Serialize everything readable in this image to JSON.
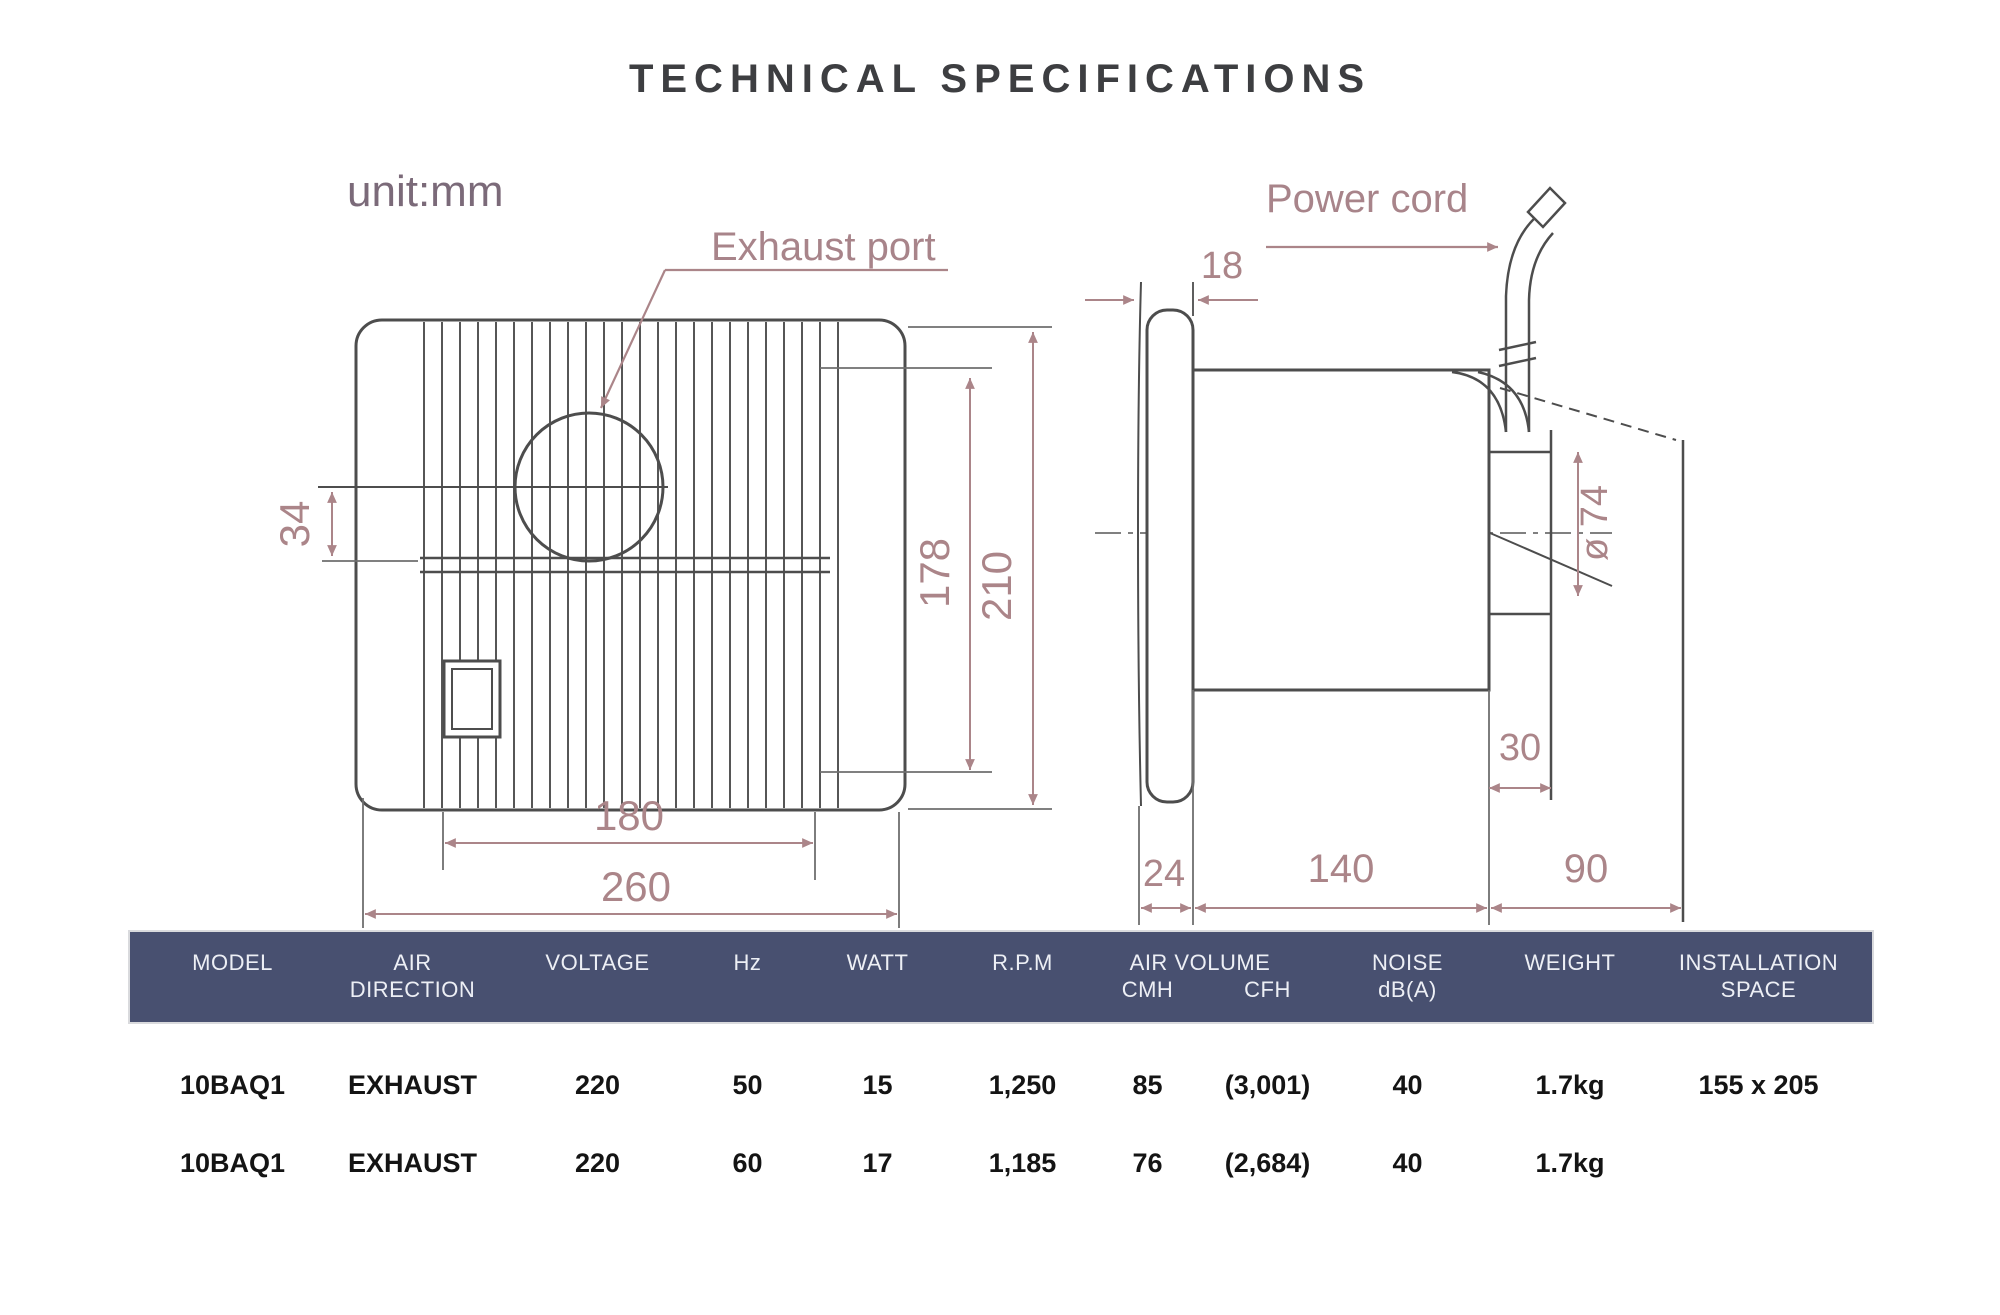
{
  "title": "TECHNICAL SPECIFICATIONS",
  "diagram": {
    "unit_label": "unit:mm",
    "exhaust_port_label": "Exhaust port",
    "power_cord_label": "Power cord",
    "front_view": {
      "switch_offset": "34",
      "inner_height": "178",
      "overall_height": "210",
      "inner_width": "180",
      "overall_width": "260"
    },
    "side_view": {
      "panel_thickness": "18",
      "duct_diameter": "ø 74",
      "duct_length": "30",
      "flange_depth": "24",
      "body_depth": "140",
      "wall_clearance": "90"
    }
  },
  "colors": {
    "header_bg": "#485070",
    "header_text": "#edeff5",
    "dimension_color": "#ab8589",
    "label_purple": "#7b6a79",
    "drawing_line": "#4d4d4d"
  },
  "table": {
    "headers": {
      "model": "MODEL",
      "air_direction_line1": "AIR",
      "air_direction_line2": "DIRECTION",
      "voltage": "VOLTAGE",
      "hz": "Hz",
      "watt": "WATT",
      "rpm": "R.P.M",
      "air_volume": "AIR VOLUME",
      "cmh": "CMH",
      "cfh": "CFH",
      "noise_line1": "NOISE",
      "noise_line2": "dB(A)",
      "weight": "WEIGHT",
      "installation_line1": "INSTALLATION",
      "installation_line2": "SPACE"
    },
    "rows": [
      {
        "model": "10BAQ1",
        "air_direction": "EXHAUST",
        "voltage": "220",
        "hz": "50",
        "watt": "15",
        "rpm": "1,250",
        "cmh": "85",
        "cfh": "(3,001)",
        "noise": "40",
        "weight": "1.7kg",
        "installation": "155 x 205"
      },
      {
        "model": "10BAQ1",
        "air_direction": "EXHAUST",
        "voltage": "220",
        "hz": "60",
        "watt": "17",
        "rpm": "1,185",
        "cmh": "76",
        "cfh": "(2,684)",
        "noise": "40",
        "weight": "1.7kg",
        "installation": ""
      }
    ]
  }
}
